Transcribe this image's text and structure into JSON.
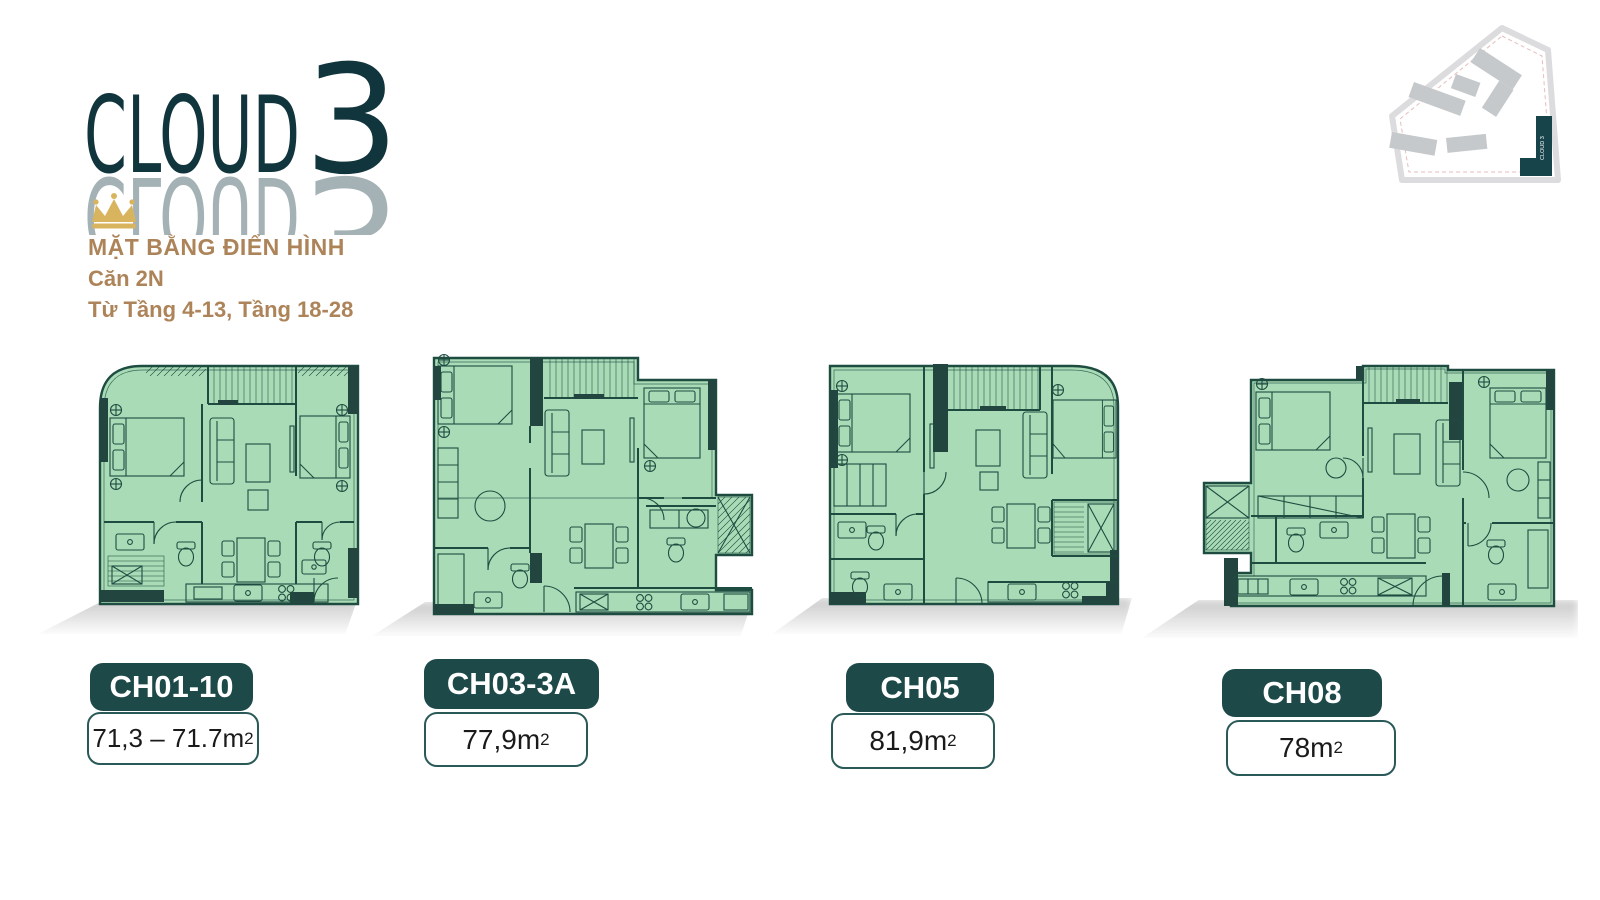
{
  "brand": {
    "logo_word": "CLOUD",
    "logo_digit": "3"
  },
  "header": {
    "title": "MẶT BẰNG ĐIỂN HÌNH",
    "unit_type": "Căn 2N",
    "floors": "Từ Tầng 4-13, Tầng 18-28"
  },
  "site_map": {
    "building_label": "CLOUD 3"
  },
  "units": [
    {
      "code": "CH01-10",
      "area": "71,3 – 71.7m",
      "area_sup": "2"
    },
    {
      "code": "CH03-3A",
      "area": "77,9m",
      "area_sup": "2"
    },
    {
      "code": "CH05",
      "area": "81,9m",
      "area_sup": "2"
    },
    {
      "code": "CH08",
      "area": "78m",
      "area_sup": "2"
    }
  ],
  "colors": {
    "logo_teal": "#11353c",
    "badge_teal": "#1d4a49",
    "plan_fill": "#a9dcb6",
    "plan_line": "#1f4c41",
    "wall_block": "#23453f",
    "heading_brown": "#ad8459",
    "crown_gold": "#d9b45f",
    "map_gray": "#c6c9cb"
  }
}
